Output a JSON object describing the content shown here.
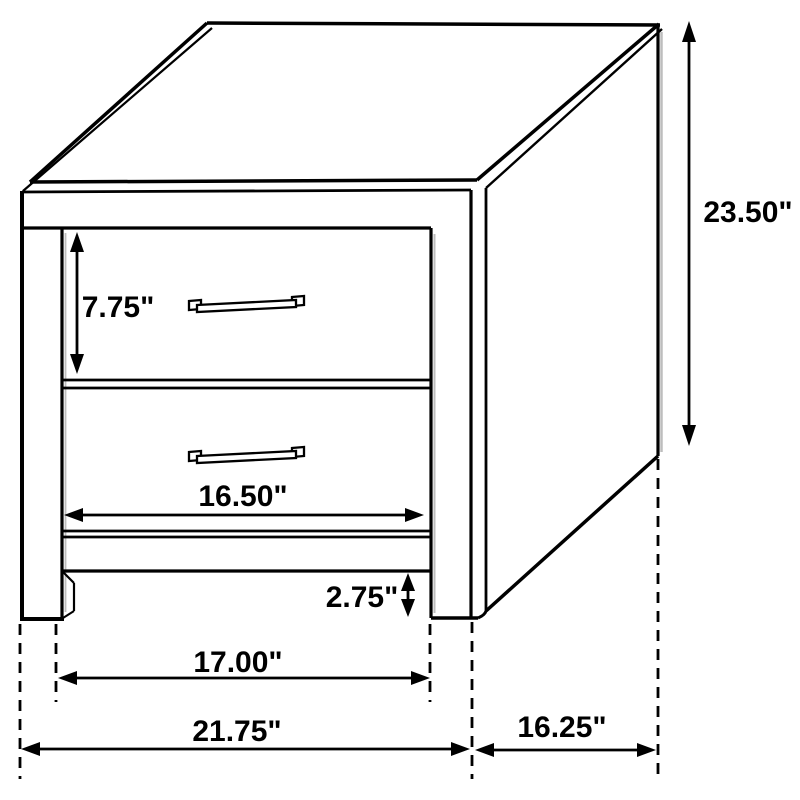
{
  "diagram": {
    "kind": "furniture-dimension-drawing",
    "subject": "two-drawer nightstand",
    "unit": "inches",
    "labels": {
      "height": "23.50\"",
      "drawer_height": "7.75\"",
      "drawer_width": "16.50\"",
      "bottom_clearance": "2.75\"",
      "inner_leg_width": "17.00\"",
      "overall_width": "21.75\"",
      "depth": "16.25\""
    },
    "colors": {
      "line": "#000000",
      "background": "#ffffff",
      "shadow": "#bdbdbd"
    }
  }
}
